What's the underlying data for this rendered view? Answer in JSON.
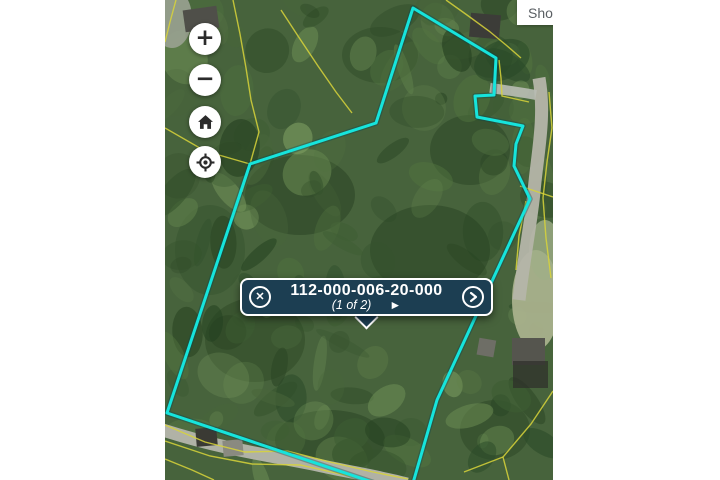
{
  "app": {
    "show_button_label": "Show"
  },
  "controls": {
    "zoom_in_glyph": "+",
    "zoom_out_glyph": "−"
  },
  "popup": {
    "parcel_id": "112-000-006-20-000",
    "page_indicator": "(1 of 2)",
    "close_symbol": "✕",
    "play_symbol": "►"
  },
  "map": {
    "selected_parcel": {
      "outline_color": "#16e4dc",
      "points": "375,483 167,413 250,164 376,123 413,8 496,58 494,95 475,96 477,117 523,126 516,144 514,166 530,199 437,400 413,483"
    },
    "parcel_line_color": "#d8d33a",
    "boundary_lines": [
      "176,0 170,22 165,42",
      "233,0 240,34 246,68 251,100 259,132 250,164",
      "165,128 205,151 250,164",
      "281,10 298,36 318,66 336,92 352,113",
      "446,0 467,15 489,31 506,45 521,58",
      "499,60 501,78 502,96 529,102",
      "549,92 552,128 547,162 543,198 546,238 551,278",
      "520,186 553,197",
      "526,201 519,236 516,270",
      "553,391 531,424 503,457 509,480",
      "503,457 464,472",
      "165,425 205,442 245,452 287,451 330,462 373,472 408,479",
      "165,441 210,456 252,464 300,465 345,475 373,481",
      "165,459 192,470 214,480",
      "250,164 242,192"
    ]
  }
}
